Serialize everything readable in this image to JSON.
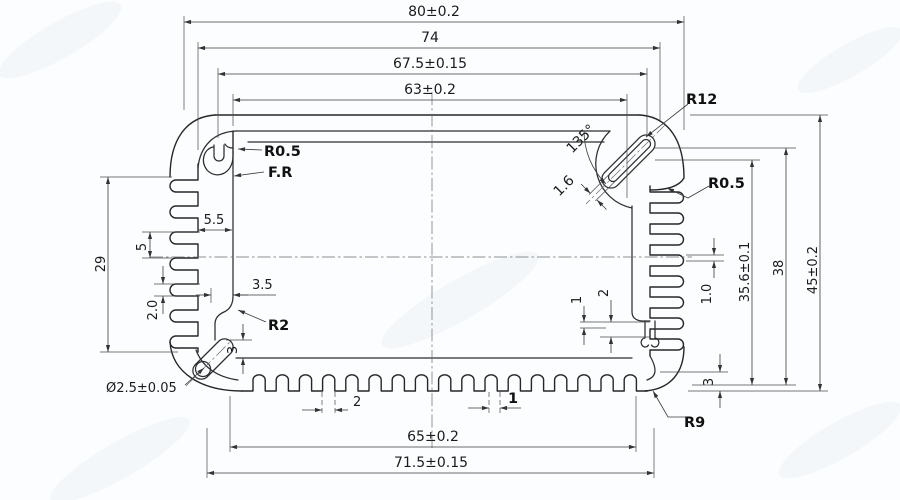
{
  "colors": {
    "paper": "#fcfdfe",
    "line": "#262626",
    "dim": "#3a3a3a"
  },
  "dims": {
    "top": [
      "80±0.2",
      "74",
      "67.5±0.15",
      "63±0.2"
    ],
    "bottom": {
      "tooth_pitch": "2",
      "tooth_width": "1",
      "width_inner": "65±0.2",
      "width_outer": "71.5±0.15"
    },
    "right": {
      "height_hole": "35.6±0.1",
      "height_mid": "38",
      "height_overall": "45±0.2",
      "fin_gap": "1.0",
      "tooth_height": "3"
    },
    "left": {
      "fin_zone_height": "29",
      "fin_pitch": "5",
      "wall": "5.5",
      "fin_thickness": "2.0",
      "step": "3.5",
      "step_height": "3",
      "hole_dia": "Ø2.5±0.05"
    },
    "inner": {
      "ledge_small": "1",
      "ledge_large": "2"
    },
    "slot": {
      "angle": "135°",
      "width": "1.6"
    }
  },
  "callouts": {
    "r12": "R12",
    "r05_right": "R0.5",
    "r05_left": "R0.5",
    "full_radius": "F.R",
    "r2": "R2",
    "r9": "R9"
  }
}
